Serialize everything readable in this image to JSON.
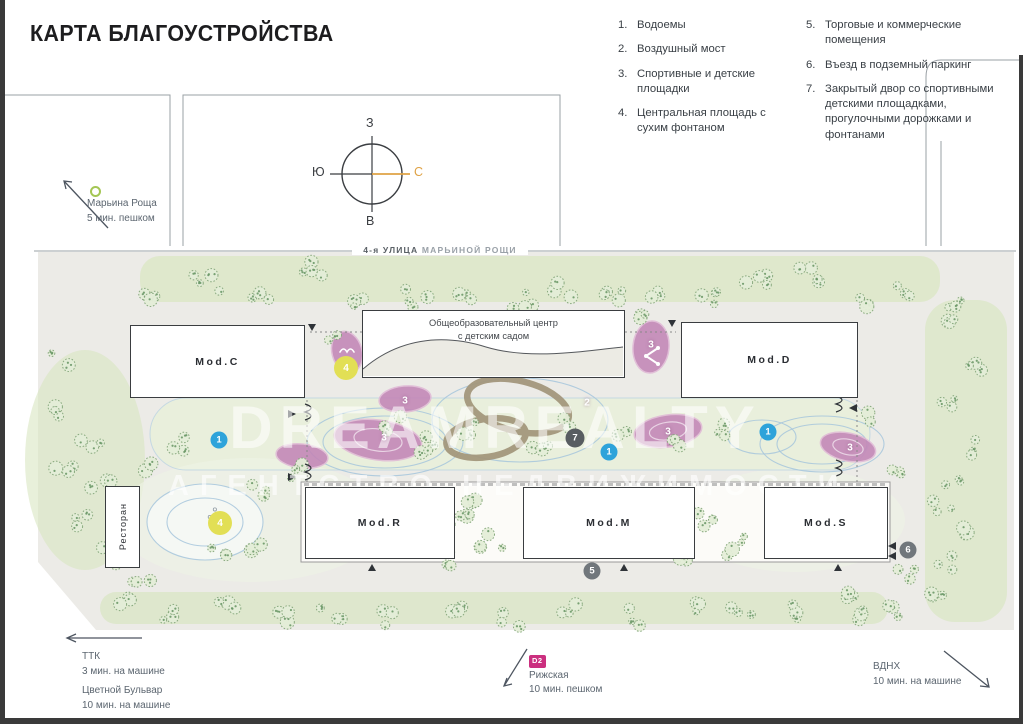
{
  "title": "КАРТА БЛАГОУСТРОЙСТВА",
  "colors": {
    "map_bg": "#ECEBE7",
    "green_band": "#D9E6C2",
    "courtyard_green": "#E9F0DA",
    "tree_fill": "#E4EED8",
    "tree_stroke": "#85A77B",
    "pond_stroke": "#A6C6DC",
    "playground_pink": "#C386B7",
    "bridge_tan": "#A2957A",
    "marker_blue": "#2EA3DA",
    "marker_yellow": "#E2DF55",
    "marker_gray": "#71777C",
    "marker_dark": "#585D61",
    "accent_east": "#DFA245",
    "badge_pink": "#CB2F7F",
    "line_gray": "#9AA0A5",
    "text_dark": "#1D1D1F",
    "note_text": "#5C6670",
    "building_border": "#3A3D40"
  },
  "legend": {
    "items": [
      {
        "num": "1.",
        "text": "Водоемы"
      },
      {
        "num": "2.",
        "text": "Воздушный мост"
      },
      {
        "num": "3.",
        "text": "Спортивные и детские площадки"
      },
      {
        "num": "4.",
        "text": "Центральная площадь с сухим фонтаном"
      },
      {
        "num": "5.",
        "text": "Торговые и коммерческие помещения"
      },
      {
        "num": "6.",
        "text": "Въезд в подземный паркинг"
      },
      {
        "num": "7.",
        "text": "Закрытый двор со спортивными детскими площадками, прогулочными дорожками и фонтанами"
      }
    ]
  },
  "compass": {
    "top": "З",
    "left": "Ю",
    "right": "С",
    "bottom": "В"
  },
  "metro_note": {
    "name": "Марьина Роща",
    "time": "5 мин. пешком"
  },
  "street": {
    "part1": "4-я УЛИЦА",
    "part2": " МАРЬИНОЙ РОЩИ"
  },
  "buildings": {
    "mod_c": "Mod.C",
    "school_line1": "Общеобразовательный центр",
    "school_line2": "с детским садом",
    "mod_d": "Mod.D",
    "restaurant": "Ресторан",
    "mod_r": "Mod.R",
    "mod_m": "Mod.M",
    "mod_s": "Mod.S"
  },
  "map": {
    "markers": [
      {
        "n": "1",
        "x": 219,
        "y": 440,
        "kind": "blue"
      },
      {
        "n": "1",
        "x": 609,
        "y": 452,
        "kind": "blue"
      },
      {
        "n": "1",
        "x": 768,
        "y": 432,
        "kind": "blue"
      },
      {
        "n": "2",
        "x": 587,
        "y": 403,
        "kind": "label"
      },
      {
        "n": "3",
        "x": 405,
        "y": 401,
        "kind": "label"
      },
      {
        "n": "3",
        "x": 384,
        "y": 438,
        "kind": "label"
      },
      {
        "n": "3",
        "x": 651,
        "y": 345,
        "kind": "label"
      },
      {
        "n": "3",
        "x": 668,
        "y": 432,
        "kind": "label"
      },
      {
        "n": "3",
        "x": 850,
        "y": 448,
        "kind": "label"
      },
      {
        "n": "4",
        "x": 346,
        "y": 368,
        "kind": "yellow"
      },
      {
        "n": "4",
        "x": 220,
        "y": 523,
        "kind": "yellow"
      },
      {
        "n": "5",
        "x": 592,
        "y": 571,
        "kind": "gray"
      },
      {
        "n": "6",
        "x": 908,
        "y": 550,
        "kind": "gray"
      },
      {
        "n": "7",
        "x": 575,
        "y": 438,
        "kind": "dark"
      }
    ]
  },
  "notes": {
    "ttk": {
      "line1": "ТТК",
      "line2": "3 мин. на машине"
    },
    "tsvetnoy": {
      "line1": "Цветной Бульвар",
      "line2": "10 мин. на машине"
    },
    "rizhskaya": {
      "badge": "D2",
      "line1": "Рижская",
      "line2": "10 мин. пешком"
    },
    "vdnh": {
      "line1": "ВДНХ",
      "line2": "10 мин. на машине"
    }
  },
  "watermark": {
    "big": "DREAMREALTY",
    "small": "АГЕНТСТВО НЕДВИЖИМОСТИ"
  }
}
